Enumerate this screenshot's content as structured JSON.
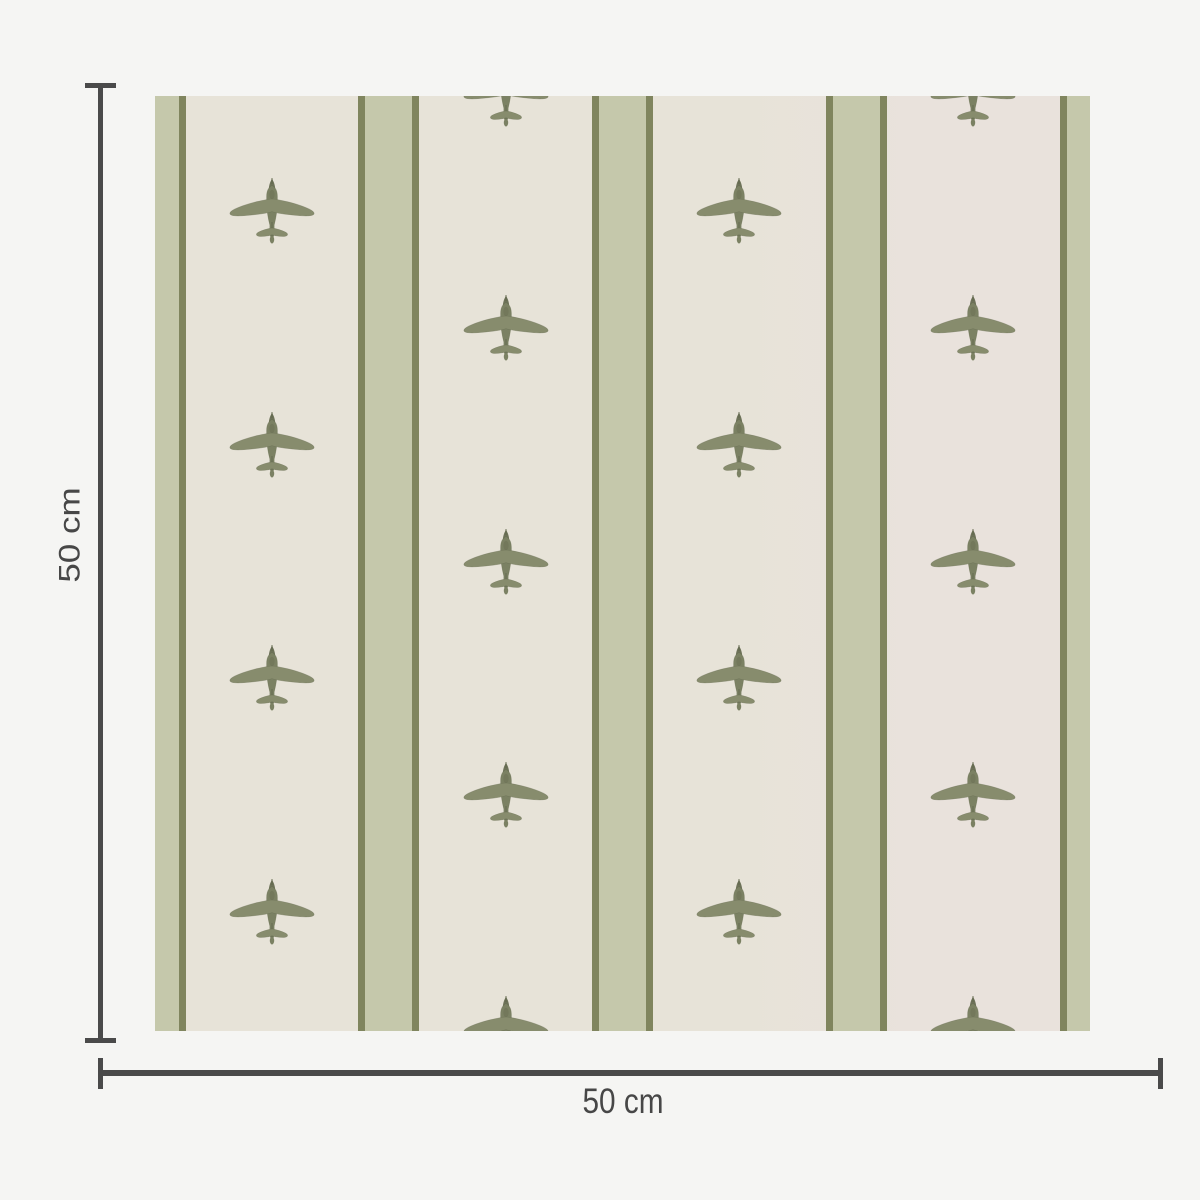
{
  "product": {
    "name": "airplane-stripe-wallpaper-swatch",
    "pattern": {
      "motif": "airplane",
      "colors": {
        "page_bg": "#f5f5f3",
        "cream": "#e7e3d8",
        "cream_right": "#e9e2dc",
        "sage": "#c5c8ab",
        "olive_edge": "#80855e",
        "plane_body": "#7b8163",
        "plane_wing": "#878c6d",
        "plane_dark": "#5f654a"
      },
      "stripe": {
        "edge_width": 7,
        "core_width": 47,
        "centers": [
          0,
          233.75,
          467.5,
          701.25,
          935
        ]
      },
      "planes": {
        "width": 88,
        "height": 70,
        "columns": [
          {
            "x": 116.9,
            "rows": [
              116.9,
              350.65,
              584.4,
              818.15
            ]
          },
          {
            "x": 350.6,
            "rows": [
              0,
              233.75,
              467.5,
              701.25,
              935
            ]
          },
          {
            "x": 584.4,
            "rows": [
              116.9,
              350.65,
              584.4,
              818.15
            ]
          },
          {
            "x": 818.1,
            "rows": [
              0,
              233.75,
              467.5,
              701.25,
              935
            ]
          }
        ]
      }
    }
  },
  "dimensions": {
    "height_label": "50 cm",
    "width_label": "50 cm",
    "line_color": "#4a4a4a",
    "text_color": "#474747"
  }
}
